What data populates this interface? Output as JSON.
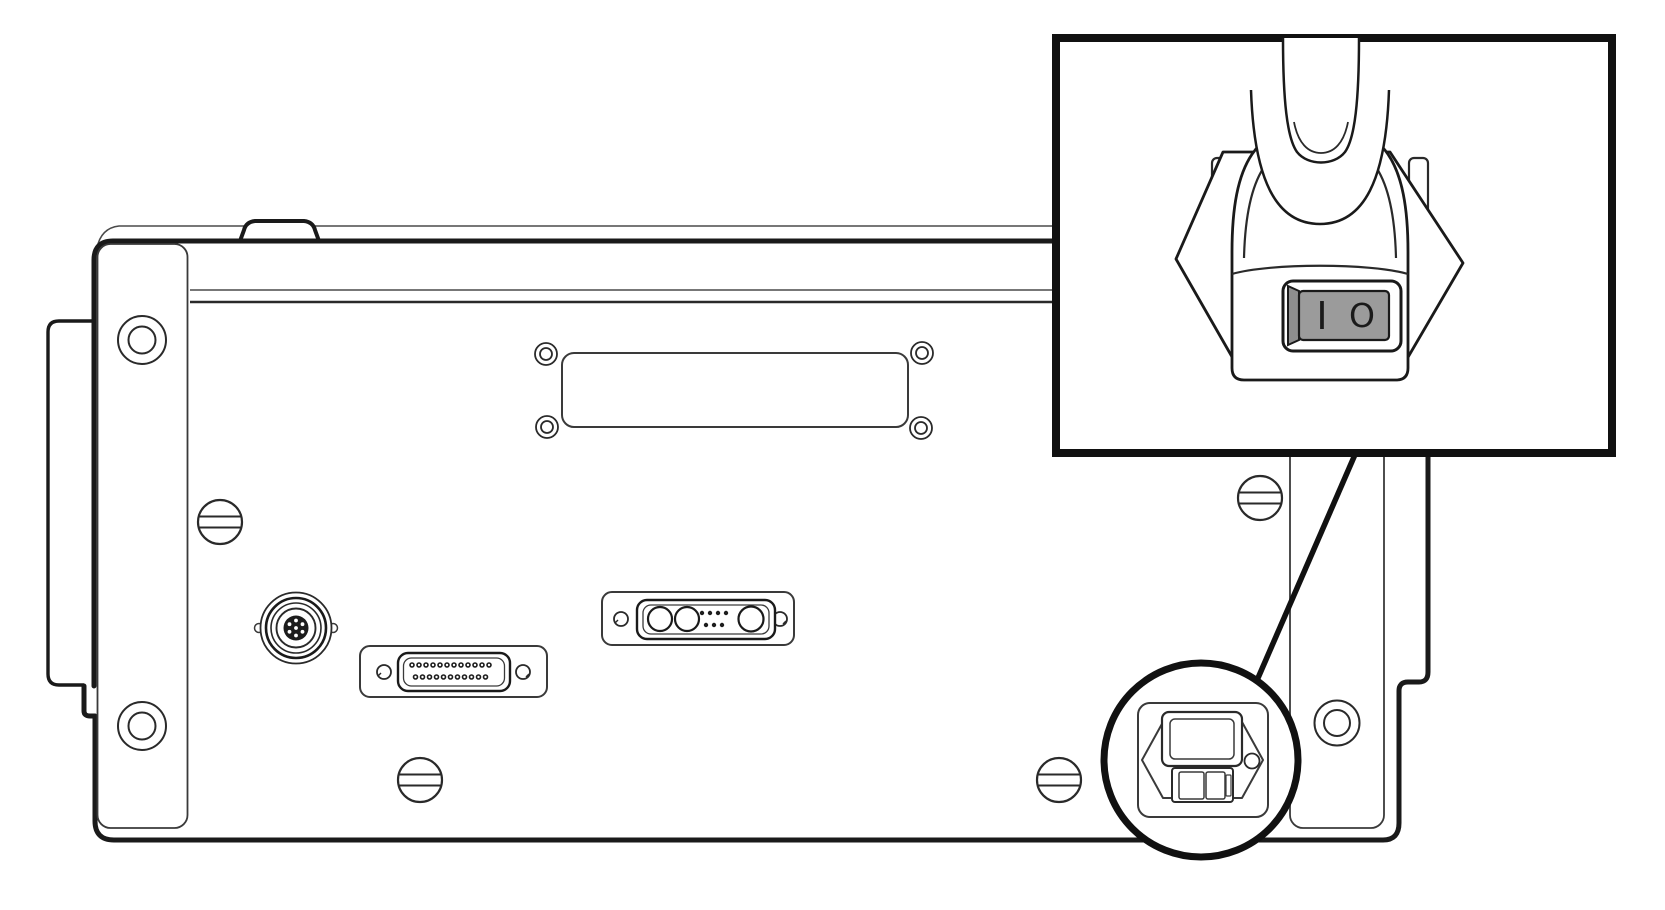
{
  "diagram": {
    "title": "Instrument rear panel with power switch detail callout",
    "background_color": "#ffffff",
    "line_color": "#1a1a1a",
    "panel": {
      "components": [
        {
          "name": "left-rack-ear"
        },
        {
          "name": "left-mounting-bracket",
          "screw_holes": 2
        },
        {
          "name": "right-mounting-bracket",
          "screw_holes": 1
        },
        {
          "name": "top-access-plate",
          "corner_screw_holes": 4
        },
        {
          "name": "circular-din-connector"
        },
        {
          "name": "db25-connector",
          "pins_top_row": 13,
          "pins_bottom_row": 12
        },
        {
          "name": "combo-dsub-connector",
          "large_contacts": 3,
          "small_pins": 10
        },
        {
          "name": "slotted-panel-screws",
          "count": 4
        },
        {
          "name": "power-entry-module",
          "parts": [
            "voltage-selector-window",
            "fuse-drawer",
            "release-button"
          ]
        }
      ]
    },
    "callout": {
      "shape": "circle",
      "target": "power-entry-module",
      "leader": "line-from-inset-to-circle"
    },
    "inset": {
      "content": "power-cord-plug-rear-view",
      "switch": {
        "type": "rocker",
        "on_label": "I",
        "off_label": "O",
        "rocker_color": "#9b9b9b"
      }
    }
  }
}
